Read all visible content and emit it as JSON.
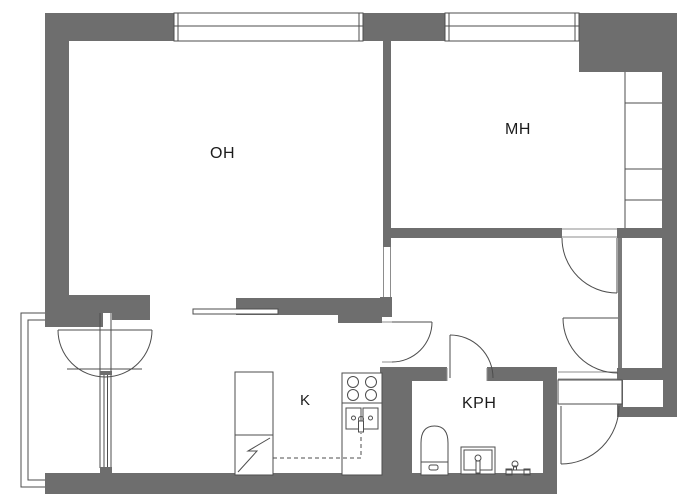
{
  "floorplan": {
    "title": "Apartment floor plan",
    "rooms": [
      {
        "id": "oh",
        "label": "OH"
      },
      {
        "id": "mh",
        "label": "MH"
      },
      {
        "id": "k",
        "label": "K"
      },
      {
        "id": "kph",
        "label": "KPH"
      }
    ],
    "colors": {
      "wall": "#6e6e6e",
      "thin_wall": "#7a7a7a",
      "line": "#4d4d4d",
      "background": "#ffffff"
    }
  }
}
